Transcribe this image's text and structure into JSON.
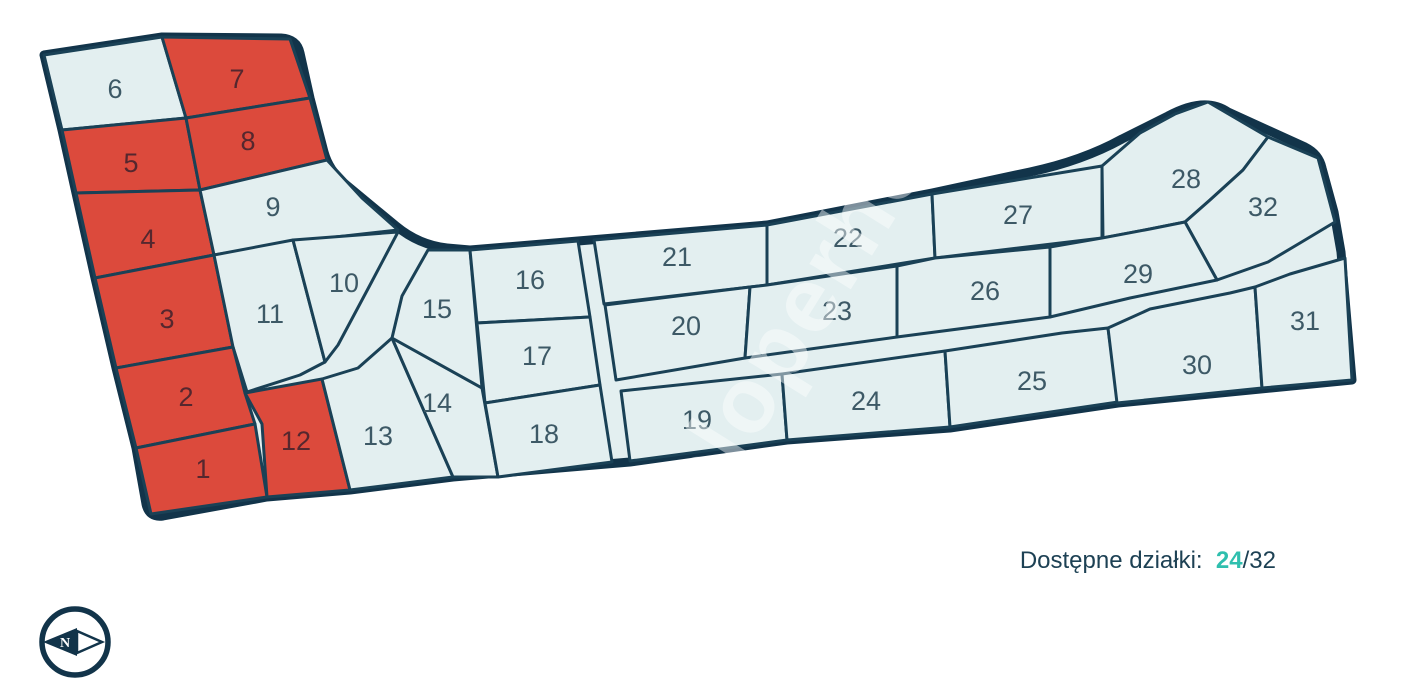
{
  "map": {
    "plots": [
      {
        "number": "1",
        "status": "sold"
      },
      {
        "number": "2",
        "status": "sold"
      },
      {
        "number": "3",
        "status": "sold"
      },
      {
        "number": "4",
        "status": "sold"
      },
      {
        "number": "5",
        "status": "sold"
      },
      {
        "number": "6",
        "status": "available"
      },
      {
        "number": "7",
        "status": "sold"
      },
      {
        "number": "8",
        "status": "sold"
      },
      {
        "number": "9",
        "status": "available"
      },
      {
        "number": "10",
        "status": "available"
      },
      {
        "number": "11",
        "status": "available"
      },
      {
        "number": "12",
        "status": "sold"
      },
      {
        "number": "13",
        "status": "available"
      },
      {
        "number": "14",
        "status": "available"
      },
      {
        "number": "15",
        "status": "available"
      },
      {
        "number": "16",
        "status": "available"
      },
      {
        "number": "17",
        "status": "available"
      },
      {
        "number": "18",
        "status": "available"
      },
      {
        "number": "19",
        "status": "available"
      },
      {
        "number": "20",
        "status": "available"
      },
      {
        "number": "21",
        "status": "available"
      },
      {
        "number": "22",
        "status": "available"
      },
      {
        "number": "23",
        "status": "available"
      },
      {
        "number": "24",
        "status": "available"
      },
      {
        "number": "25",
        "status": "available"
      },
      {
        "number": "26",
        "status": "available"
      },
      {
        "number": "27",
        "status": "available"
      },
      {
        "number": "28",
        "status": "available"
      },
      {
        "number": "29",
        "status": "available"
      },
      {
        "number": "30",
        "status": "available"
      },
      {
        "number": "31",
        "status": "available"
      },
      {
        "number": "32",
        "status": "available"
      }
    ],
    "colors": {
      "outline": "#12344A",
      "line": "#1A4156",
      "available": "#E3EFF0",
      "sold": "#DC4A3C",
      "num": "#3D5966",
      "num-sold": "#55272E",
      "accent": "#2FBFAE",
      "text": "#1D4154"
    }
  },
  "caption": {
    "label": "Dostępne działki:",
    "available_count": "24",
    "separator": "/",
    "total_count": "32"
  },
  "watermark": "deweloperhouse",
  "compass": {
    "letter": "N"
  }
}
